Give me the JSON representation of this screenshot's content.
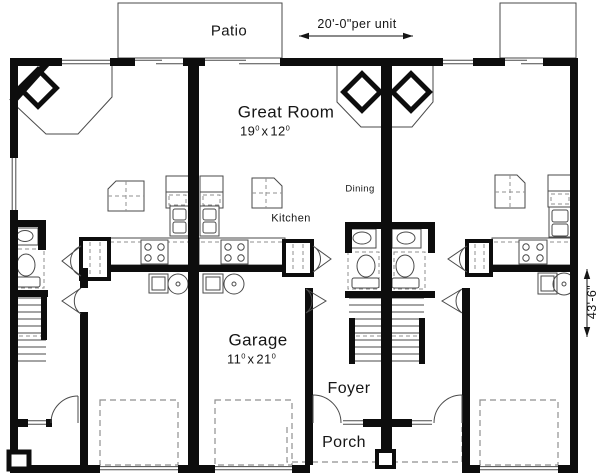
{
  "plan": {
    "labels": {
      "patio": "Patio",
      "great_room": "Great Room",
      "dining": "Dining",
      "kitchen": "Kitchen",
      "garage": "Garage",
      "foyer": "Foyer",
      "porch": "Porch"
    },
    "dimensions": {
      "per_unit": "20'-0\"per unit",
      "depth": "43'-6\"",
      "great_room_size": {
        "w": "19",
        "w_sup": "0",
        "sep": "x",
        "h": "12",
        "h_sup": "0"
      },
      "garage_size": {
        "w": "11",
        "w_sup": "0",
        "sep": "x",
        "h": "21",
        "h_sup": "0"
      }
    },
    "colors": {
      "wall": "#0d0d0d",
      "line": "#4a4a4a",
      "dashed": "#8f8f8f",
      "text": "#151515",
      "background": "#ffffff"
    }
  }
}
